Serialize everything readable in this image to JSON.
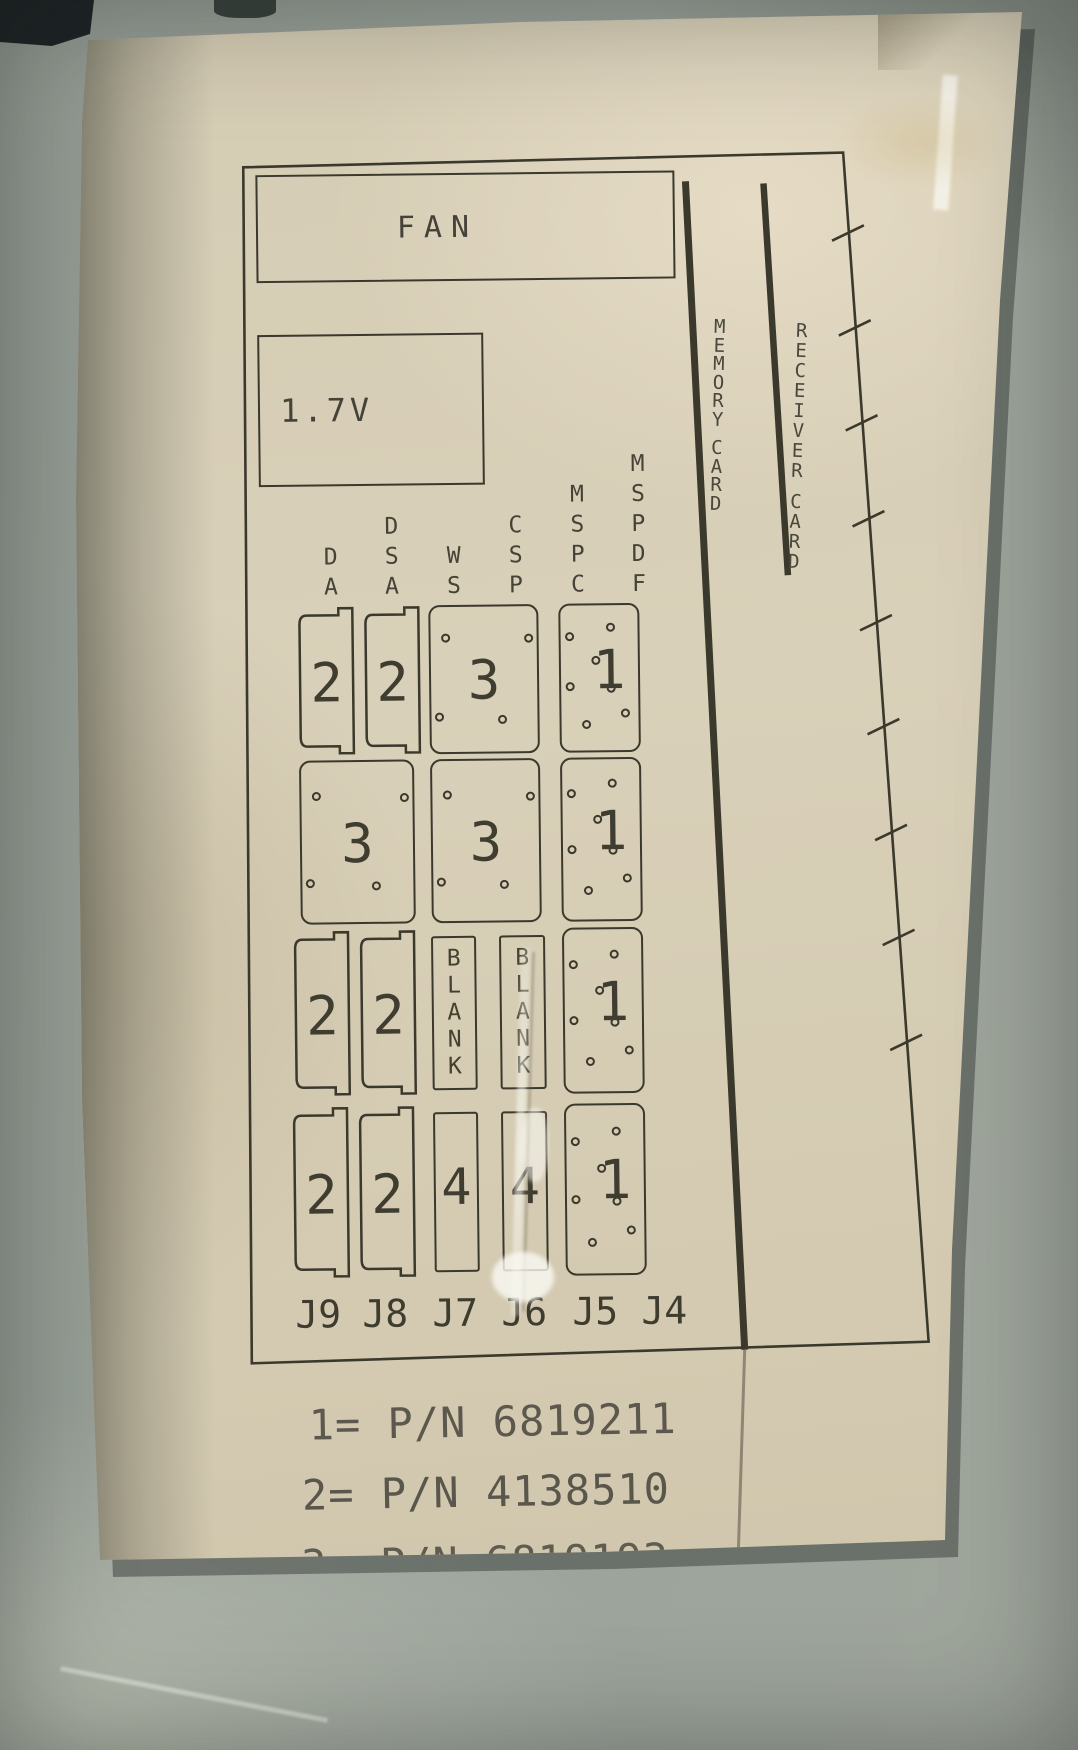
{
  "photo": {
    "surface_color": "#99a19a",
    "paper_color": "#d8cfb8",
    "ink_color": "#3b382c"
  },
  "diagram": {
    "fan_label": "FAN",
    "voltage_label": "1.7V",
    "memory_card_label": "MEMORY CARD",
    "receiver_card_label": "RECEIVER CARD",
    "column_labels": [
      "DA",
      "DSA",
      "WS",
      "CSP",
      "MSPC",
      "MSPDF"
    ],
    "connector_labels": [
      "J9",
      "J8",
      "J7",
      "J6",
      "J5",
      "J4"
    ],
    "grid_rows": [
      {
        "cells": [
          {
            "col": "J9",
            "shape": "notched",
            "label": "2"
          },
          {
            "col": "J8",
            "shape": "notched",
            "label": "2"
          },
          {
            "col": "J7J6",
            "shape": "dotted4",
            "label": "3"
          },
          {
            "col": "J5J4",
            "shape": "dotted7",
            "label": "1"
          }
        ]
      },
      {
        "cells": [
          {
            "col": "J9J8",
            "shape": "dotted4",
            "label": "3"
          },
          {
            "col": "J7J6",
            "shape": "dotted4",
            "label": "3"
          },
          {
            "col": "J5J4",
            "shape": "dotted7",
            "label": "1"
          }
        ]
      },
      {
        "cells": [
          {
            "col": "J9",
            "shape": "notched",
            "label": "2"
          },
          {
            "col": "J8",
            "shape": "notched",
            "label": "2"
          },
          {
            "col": "J7",
            "shape": "blank",
            "label": "BLANK"
          },
          {
            "col": "J6",
            "shape": "blank",
            "label": "BLANK"
          },
          {
            "col": "J5J4",
            "shape": "dotted7",
            "label": "1"
          }
        ]
      },
      {
        "cells": [
          {
            "col": "J9",
            "shape": "notched",
            "label": "2"
          },
          {
            "col": "J8",
            "shape": "notched",
            "label": "2"
          },
          {
            "col": "J7",
            "shape": "plain",
            "label": "4"
          },
          {
            "col": "J6",
            "shape": "plain",
            "label": "4"
          },
          {
            "col": "J5J4",
            "shape": "dotted7",
            "label": "1"
          }
        ]
      }
    ],
    "legend_lines": [
      "1= P/N 6819211",
      "2= P/N 4138510",
      "3= P/N 6819193",
      "4= P/N 6369779"
    ]
  }
}
